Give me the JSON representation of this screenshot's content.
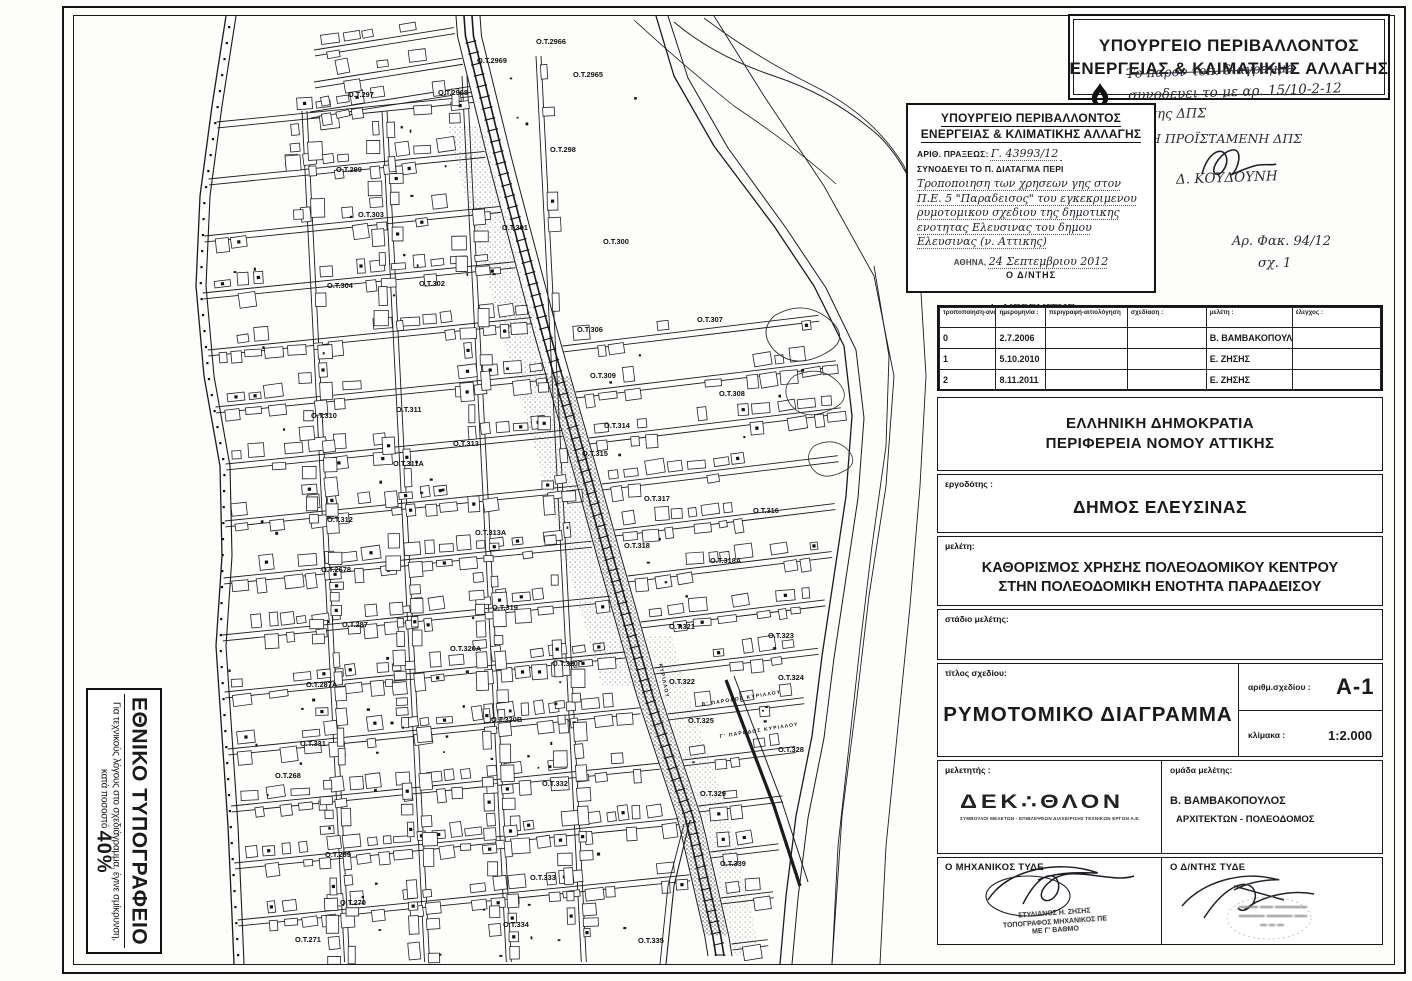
{
  "ministry_header": {
    "line1": "ΥΠΟΥΡΓΕΙΟ ΠΕΡΙΒΑΛΛΟΝΤΟΣ",
    "line2": "ΕΝΕΡΓΕΙΑΣ & ΚΛΙΜΑΤΙΚΗΣ ΑΛΛΑΓΗΣ"
  },
  "handwritten_notes": {
    "struck_line": "Το παρον τοπ. διαγραμμα",
    "line2": "συνοδευει το με αρ. 15/10-2-12",
    "line3": "Υ.Σ  της  ΔΠΣ",
    "approver_title": "Η  ΠΡΟΪΣΤΑΜΕΝΗ  ΔΠΣ",
    "approver_name": "Δ. ΚΟΥΔΟΥΝΗ",
    "file_ref": "Αρ. Φακ. 94/12",
    "sheet_ref": "σχ. 1"
  },
  "stamp_box": {
    "title1": "ΥΠΟΥΡΓΕΙΟ  ΠΕΡΙΒΑΛΛΟΝΤΟΣ",
    "title2": "ΕΝΕΡΓΕΙΑΣ  &  ΚΛΙΜΑΤΙΚΗΣ  ΑΛΛΑΓΗΣ",
    "act_label": "ΑΡΙΘ. ΠΡΑΞΕΩΣ:",
    "act_number": "Γ. 43993/12",
    "accompanies_label": "ΣΥΝΟΔΕΥΕΙ ΤΟ Π. ΔΙΑΤΑΓΜΑ ΠΕΡΙ",
    "subject_handwritten": "Τροποποιηση των χρησεων γης στον Π.Ε. 5 \"Παραδεισος\" του εγκεκριμενου ρυμοτομικου σχεδιου της δημοτικης ενοτητας Ελευσινας του δημου Ελευσινας (ν. Αττικης)",
    "city_label": "ΑΘΗΝΑ,",
    "date_handwritten": "24 Σεπτεμβριου 2012",
    "director_label": "Ο  Δ/ΝΤΗΣ",
    "director_name": "Α. ΝΕΡΕΝΙΤΗΣ"
  },
  "revision_table": {
    "headers": [
      "τροποποίηση-αναθεώρηση",
      "ημερομηνία :",
      "περιγραφή-αιτιολόγηση",
      "σχεδίαση :",
      "μελέτη :",
      "έλεγχος :"
    ],
    "rows": [
      [
        "0",
        "2.7.2006",
        "",
        "",
        "Β. ΒΑΜΒΑΚΟΠΟΥΛΟΣ",
        ""
      ],
      [
        "1",
        "5.10.2010",
        "",
        "",
        "Ε. ΖΗΣΗΣ",
        ""
      ],
      [
        "2",
        "8.11.2011",
        "",
        "",
        "Ε. ΖΗΣΗΣ",
        ""
      ]
    ]
  },
  "title_block": {
    "authority_line1": "ΕΛΛΗΝΙΚΗ ΔΗΜΟΚΡΑΤΙΑ",
    "authority_line2": "ΠΕΡΙΦΕΡΕΙΑ  ΝΟΜΟΥ ΑΤΤΙΚΗΣ",
    "client_label": "εργοδότης :",
    "client": "ΔΗΜΟΣ ΕΛΕΥΣΙΝΑΣ",
    "study_label": "μελέτη:",
    "study_line1": "ΚΑΘΟΡΙΣΜΟΣ ΧΡΗΣΗΣ ΠΟΛΕΟΔΟΜΙΚΟΥ ΚΕΝΤΡΟΥ",
    "study_line2": "ΣΤΗΝ ΠΟΛΕΟΔΟΜΙΚΗ ΕΝΟΤΗΤΑ ΠΑΡΑΔΕΙΣΟΥ",
    "stage_label": "στάδιο μελέτης:",
    "drawing_title_label": "τίτλος σχεδίου:",
    "drawing_title": "ΡΥΜΟΤΟΜΙΚΟ ΔΙΑΓΡΑΜΜΑ",
    "drawing_no_label": "αριθμ.σχεδίου :",
    "drawing_no": "Α-1",
    "scale_label": "κλίμακα :",
    "scale": "1:2.000",
    "designer_label": "μελετητής :",
    "designer_logo": "ΔΕΚ∴ΘΛΟΝ",
    "designer_tagline": "ΣΥΜΒΟΥΛΟΙ ΜΕΛΕΤΩΝ - ΕΠΙΒΛΕΨΕΩΝ ΔΙΑΧΕΙΡΙΣΗΣ ΤΕΧΝΙΚΩΝ ΕΡΓΩΝ Α.Ε.",
    "team_label": "ομάδα μελέτης:",
    "team_name": "Β. ΒΑΜΒΑΚΟΠΟΥΛΟΣ",
    "team_role": "ΑΡΧΙΤΕΚΤΩΝ - ΠΟΛΕΟΔΟΜΟΣ",
    "engineer_label": "Ο ΜΗΧΑΝΙΚΟΣ ΤΥΔΕ",
    "engineer_stamp_line1": "ΣΤΥΛΙΑΝΟΣ Η. ΖΗΣΗΣ",
    "engineer_stamp_line2": "ΤΟΠΟΓΡΑΦΟΣ ΜΗΧΑΝΙΚΟΣ ΠΕ",
    "engineer_stamp_line3": "ΜΕ Γ' ΒΑΘΜΟ",
    "director_label": "Ο Δ/ΝΤΗΣ ΤΥΔΕ"
  },
  "printing_note": {
    "title": "ΕΘΝΙΚΟ ΤΥΠΟΓΡΑΦΕΙΟ",
    "note": "Για τεχνικούς λόγους στο σχεδιάγραμμα, έγινε σμίκρυνση, κατά ποσοστό ",
    "percent": "40%"
  },
  "map": {
    "block_labels": [
      {
        "t": "Ο.Τ.2966",
        "x": 462,
        "y": 28
      },
      {
        "t": "Ο.Τ.2969",
        "x": 403,
        "y": 47
      },
      {
        "t": "Ο.Τ.2968",
        "x": 364,
        "y": 79
      },
      {
        "t": "Ο.Τ.2965",
        "x": 499,
        "y": 61
      },
      {
        "t": "Ο.Τ.297",
        "x": 274,
        "y": 81
      },
      {
        "t": "Ο.Τ.298",
        "x": 476,
        "y": 136
      },
      {
        "t": "Ο.Τ.299",
        "x": 262,
        "y": 156
      },
      {
        "t": "Ο.Τ.303",
        "x": 284,
        "y": 201
      },
      {
        "t": "Ο.Τ.301",
        "x": 428,
        "y": 214
      },
      {
        "t": "Ο.Τ.300",
        "x": 529,
        "y": 228
      },
      {
        "t": "Ο.Τ.304",
        "x": 253,
        "y": 272
      },
      {
        "t": "Ο.Τ.302",
        "x": 345,
        "y": 270
      },
      {
        "t": "Ο.Τ.306",
        "x": 503,
        "y": 316
      },
      {
        "t": "Ο.Τ.307",
        "x": 623,
        "y": 306
      },
      {
        "t": "Ο.Τ.309",
        "x": 516,
        "y": 362
      },
      {
        "t": "Ο.Τ.308",
        "x": 645,
        "y": 380
      },
      {
        "t": "Ο.Τ.310",
        "x": 237,
        "y": 402
      },
      {
        "t": "Ο.Τ.311",
        "x": 322,
        "y": 396
      },
      {
        "t": "Ο.Τ.313",
        "x": 379,
        "y": 430
      },
      {
        "t": "Ο.Τ.314",
        "x": 530,
        "y": 412
      },
      {
        "t": "Ο.Τ.315",
        "x": 508,
        "y": 440
      },
      {
        "t": "Ο.Τ.311Α",
        "x": 319,
        "y": 450
      },
      {
        "t": "Ο.Τ.312",
        "x": 253,
        "y": 506
      },
      {
        "t": "Ο.Τ.317",
        "x": 570,
        "y": 485
      },
      {
        "t": "Ο.Τ.313Α",
        "x": 401,
        "y": 519
      },
      {
        "t": "Ο.Τ.316",
        "x": 679,
        "y": 497
      },
      {
        "t": "Ο.Τ.318",
        "x": 550,
        "y": 532
      },
      {
        "t": "Ο.Τ.318Α",
        "x": 636,
        "y": 547
      },
      {
        "t": "Ο.Τ.2678",
        "x": 247,
        "y": 556
      },
      {
        "t": "Ο.Τ.287",
        "x": 268,
        "y": 611
      },
      {
        "t": "Ο.Τ.319",
        "x": 418,
        "y": 594
      },
      {
        "t": "Ο.Τ.320Α",
        "x": 376,
        "y": 635
      },
      {
        "t": "Ο.Τ.320Γ",
        "x": 478,
        "y": 650
      },
      {
        "t": "Ο.Τ.321",
        "x": 595,
        "y": 613
      },
      {
        "t": "Ο.Τ.322",
        "x": 595,
        "y": 668
      },
      {
        "t": "Ο.Τ.323",
        "x": 694,
        "y": 622
      },
      {
        "t": "Ο.Τ.324",
        "x": 704,
        "y": 664
      },
      {
        "t": "Ο.Τ.287Α",
        "x": 232,
        "y": 671
      },
      {
        "t": "Ο.Τ.320Β",
        "x": 417,
        "y": 706
      },
      {
        "t": "Ο.Τ.331",
        "x": 226,
        "y": 730
      },
      {
        "t": "Ο.Τ.325",
        "x": 614,
        "y": 707
      },
      {
        "t": "Ο.Τ.328",
        "x": 704,
        "y": 736
      },
      {
        "t": "Ο.Τ.268",
        "x": 201,
        "y": 762
      },
      {
        "t": "Ο.Τ.332",
        "x": 468,
        "y": 770
      },
      {
        "t": "Ο.Τ.329",
        "x": 626,
        "y": 780
      },
      {
        "t": "Ο.Τ.269",
        "x": 251,
        "y": 841
      },
      {
        "t": "Ο.Τ.333",
        "x": 456,
        "y": 864
      },
      {
        "t": "Ο.Τ.270",
        "x": 266,
        "y": 889
      },
      {
        "t": "Ο.Τ.334",
        "x": 429,
        "y": 911
      },
      {
        "t": "Ο.Τ.271",
        "x": 221,
        "y": 926
      },
      {
        "t": "Ο.Τ.335",
        "x": 564,
        "y": 927
      },
      {
        "t": "Ο.Τ.339",
        "x": 646,
        "y": 850
      }
    ],
    "street_labels": [
      {
        "t": "Β' ΠΑΡΟΔΟΣ  ΚΥΡΙΛΛΟΥ",
        "x": 628,
        "y": 690,
        "r": -9
      },
      {
        "t": "Γ' ΠΑΡΟΔΟΣ  ΚΥΡΙΛΛΟΥ",
        "x": 646,
        "y": 722,
        "r": -9
      },
      {
        "t": "ΚΥΡΙΛΛΟΥ",
        "x": 585,
        "y": 648,
        "r": 78
      }
    ]
  }
}
